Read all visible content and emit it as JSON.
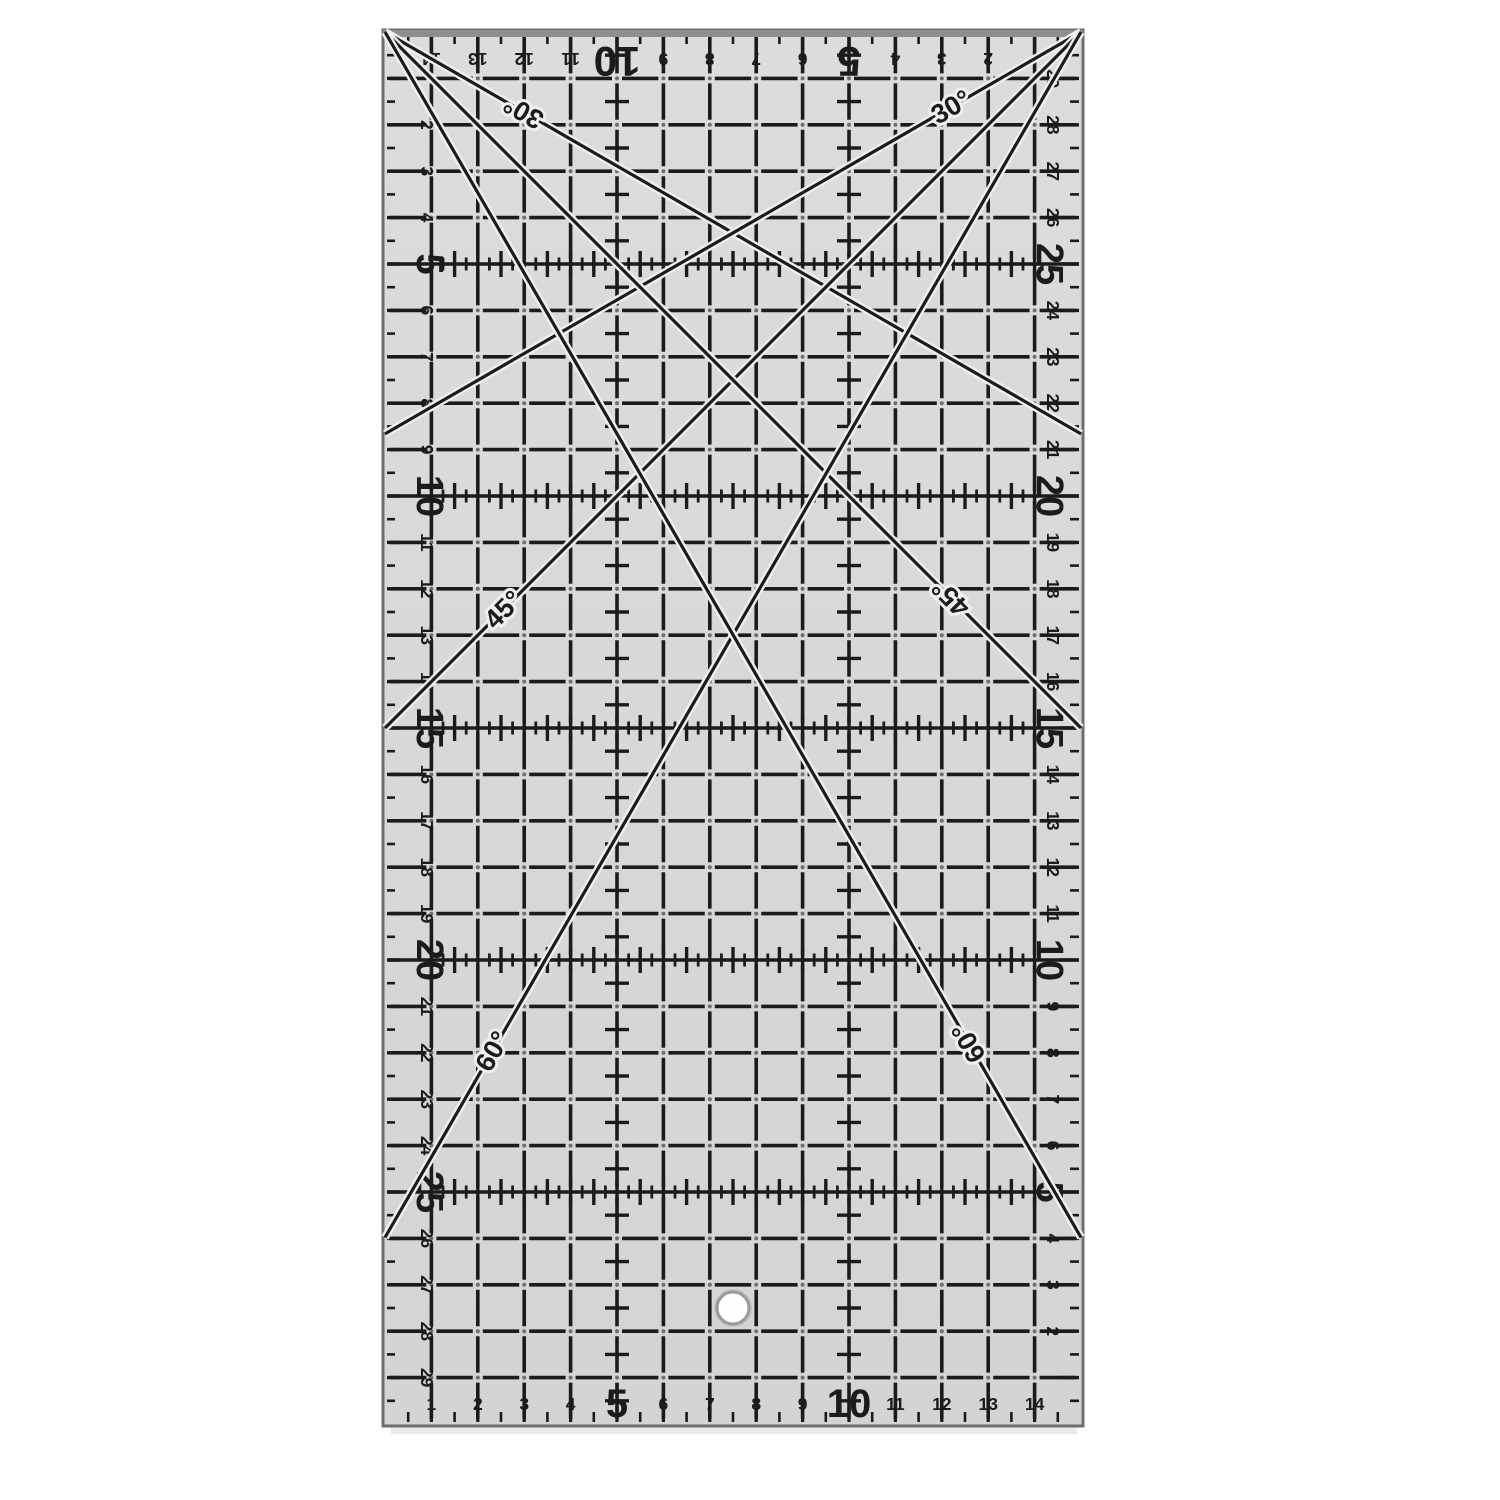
{
  "image_type": "product-photo-of-quilting-ruler",
  "canvas": {
    "width": 1500,
    "height": 1500,
    "background": "#ffffff"
  },
  "ruler": {
    "type": "transparent-quilting-ruler",
    "x": 385,
    "y": 32,
    "units_wide": 15,
    "units_tall": 30,
    "unit_px": 46.4,
    "colors": {
      "body": "#dcdcda",
      "body_shade": "#d4d4d2",
      "border": "#6e6e6e",
      "top_strip": "#8e8e8e",
      "marks": "#1b1b1b",
      "dots": "#707070",
      "halo": "#efefed",
      "hole_fill": "#fdfdfd",
      "hole_ring": "#9a9a9a",
      "shadow": "#c8c8c8"
    },
    "grid": {
      "line_width": 3.6,
      "gap_at_intersections_px": 10,
      "cross_columns": [
        5,
        10
      ],
      "tick_rows": [
        5,
        10,
        15,
        20,
        25
      ]
    },
    "scales": {
      "top": {
        "numbers": [
          2,
          3,
          4,
          5,
          6,
          7,
          8,
          9,
          10,
          11,
          12,
          13,
          14
        ],
        "big": [
          5,
          10
        ],
        "measure_from": "right",
        "orientation": "upside-down"
      },
      "bottom": {
        "numbers": [
          1,
          2,
          3,
          4,
          5,
          6,
          7,
          8,
          9,
          10,
          11,
          12,
          13,
          14
        ],
        "big": [
          5,
          10
        ],
        "measure_from": "left",
        "orientation": "upright"
      },
      "left": {
        "numbers": [
          2,
          3,
          4,
          5,
          6,
          7,
          8,
          9,
          10,
          11,
          12,
          13,
          14,
          15,
          16,
          17,
          18,
          19,
          20,
          21,
          22,
          23,
          24,
          25,
          26,
          27,
          28,
          29
        ],
        "big": [
          5,
          10,
          15,
          20,
          25
        ],
        "measure_from": "top",
        "orientation": "sideways"
      },
      "right": {
        "numbers": [
          2,
          3,
          4,
          5,
          6,
          7,
          8,
          9,
          10,
          11,
          12,
          13,
          14,
          15,
          16,
          17,
          18,
          19,
          20,
          21,
          22,
          23,
          24,
          25,
          26,
          27,
          28,
          29
        ],
        "big": [
          5,
          10,
          15,
          20,
          25
        ],
        "measure_from": "bottom",
        "orientation": "sideways"
      }
    },
    "angle_lines": [
      {
        "label": "30°",
        "corner": "top-left",
        "angle_deg": 30,
        "label_dist_px": 160
      },
      {
        "label": "30°",
        "corner": "top-right",
        "angle_deg": 30,
        "label_dist_px": 150
      },
      {
        "label": "45°",
        "corner": "top-right",
        "angle_deg": 45,
        "label_dist_px": 817
      },
      {
        "label": "45°",
        "corner": "top-left",
        "angle_deg": 45,
        "label_dist_px": 800
      },
      {
        "label": "60°",
        "corner": "top-right",
        "angle_deg": 60,
        "label_dist_px": 1177
      },
      {
        "label": "60°",
        "corner": "top-left",
        "angle_deg": 60,
        "label_dist_px": 1167
      }
    ],
    "hole": {
      "unit_x": 7.5,
      "unit_y": 27.5,
      "radius_px": 16
    }
  }
}
